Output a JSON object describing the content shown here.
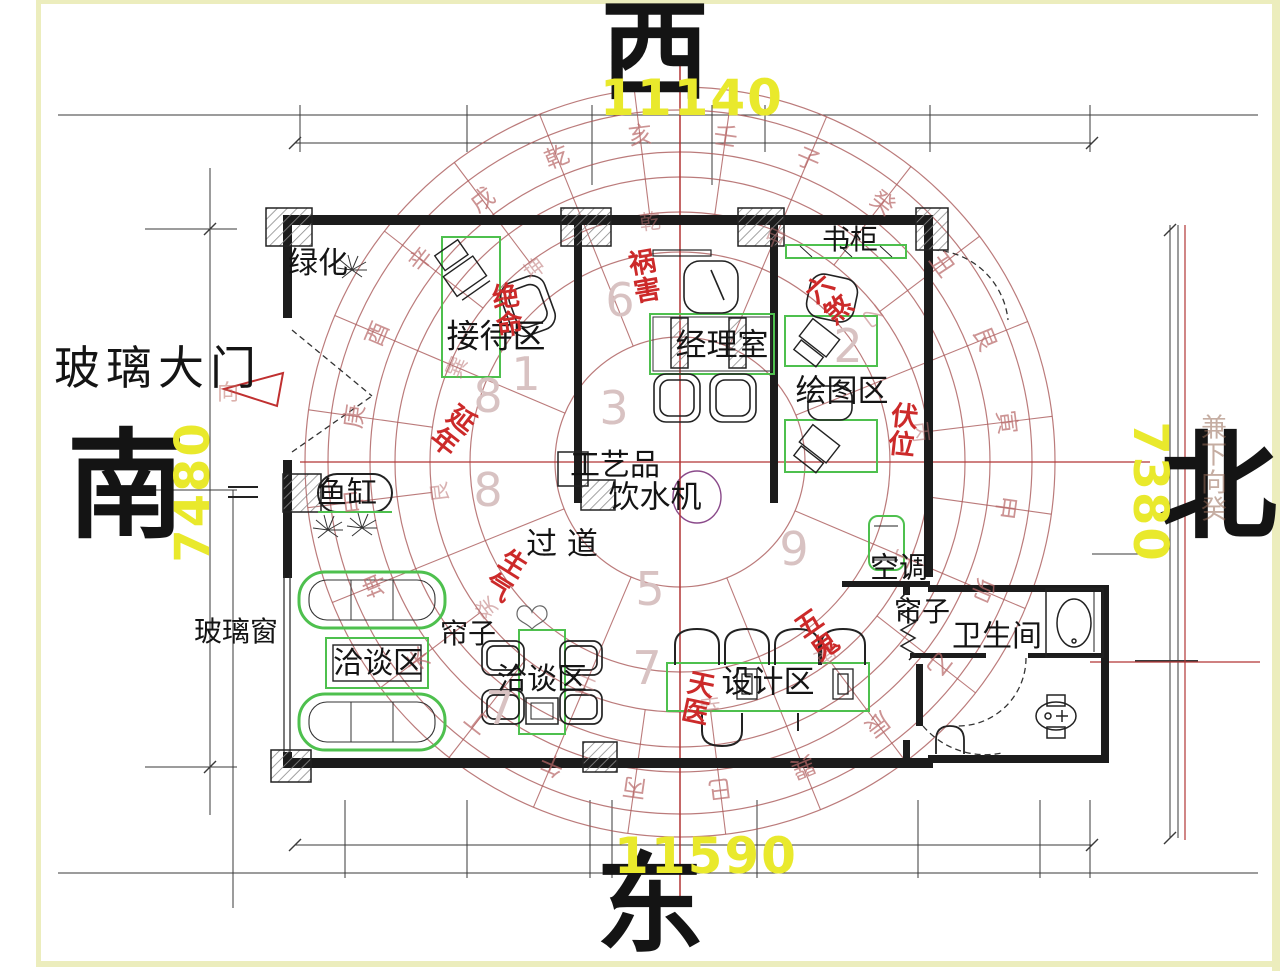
{
  "page": {
    "background": "#ffffff",
    "border_color": "#ecedbd"
  },
  "directions": {
    "west": "西",
    "east": "东",
    "south": "南",
    "north": "北"
  },
  "dimensions": {
    "top": "11140",
    "bottom": "11590",
    "left": "7480",
    "right": "7380",
    "color": "#e9e92c"
  },
  "rooms": {
    "greenery": "绿化",
    "reception": "接待区",
    "manager_office": "经理室",
    "bookcase": "书柜",
    "drafting_area": "绘图区",
    "glass_main_door": "玻璃大门",
    "fish_tank": "鱼缸",
    "crafts": "工艺品",
    "water_dispenser": "饮水机",
    "corridor": "过 道",
    "curtain_left": "帘子",
    "meeting_area_1": "洽谈区",
    "meeting_area_2": "洽谈区",
    "design_area": "设计区",
    "air_conditioner": "空调",
    "curtain_right": "帘子",
    "bathroom": "卫生间",
    "glass_window": "玻璃窗"
  },
  "fengshui": {
    "color": "#cc2a2a",
    "huo_hai": "祸害",
    "jue_ming": "绝命",
    "yan_nian": "延年",
    "sheng_qi": "生气",
    "tian_yi": "天医",
    "wu_gui": "五鬼",
    "liu_sha": "六煞",
    "fu_wei": "伏位",
    "side_note": "兼下向癸",
    "door_note": "向"
  },
  "loshu": {
    "color": "#d8c2c2",
    "numbers": [
      {
        "v": "6",
        "x": 620,
        "y": 300
      },
      {
        "v": "2",
        "x": 848,
        "y": 346
      },
      {
        "v": "1",
        "x": 526,
        "y": 374
      },
      {
        "v": "8",
        "x": 488,
        "y": 396
      },
      {
        "v": "3",
        "x": 614,
        "y": 408
      },
      {
        "v": "8",
        "x": 488,
        "y": 490
      },
      {
        "v": "9",
        "x": 794,
        "y": 549
      },
      {
        "v": "5",
        "x": 650,
        "y": 589
      },
      {
        "v": "7",
        "x": 647,
        "y": 668
      },
      {
        "v": "7",
        "x": 500,
        "y": 708
      }
    ]
  },
  "compass": {
    "center": {
      "x": 680,
      "y": 462
    },
    "ring_color": "rgba(170,90,90,0.8)",
    "axis_color": "#b23535",
    "rings": [
      {
        "radius": 331,
        "size": 24,
        "offset": 8,
        "color": "rgba(185,105,105,0.72)",
        "chars": [
          "壬",
          "子",
          "癸",
          "丑",
          "艮",
          "寅",
          "甲",
          "卯",
          "乙",
          "辰",
          "巽",
          "巳",
          "丙",
          "午",
          "丁",
          "未",
          "坤",
          "申",
          "庚",
          "酉",
          "辛",
          "戌",
          "乾",
          "亥"
        ]
      },
      {
        "radius": 243,
        "size": 21,
        "offset": 23,
        "color": "rgba(185,115,115,0.55)",
        "chars": [
          "甲",
          "乙",
          "丙",
          "丁",
          "庚",
          "辛",
          "壬",
          "癸",
          "艮",
          "巽",
          "坤",
          "乾"
        ]
      }
    ],
    "radial24": {
      "offset": 8,
      "r1": 250,
      "r2": 375
    },
    "radial8": {
      "offset": 23,
      "r1": 125,
      "r2": 250
    }
  }
}
